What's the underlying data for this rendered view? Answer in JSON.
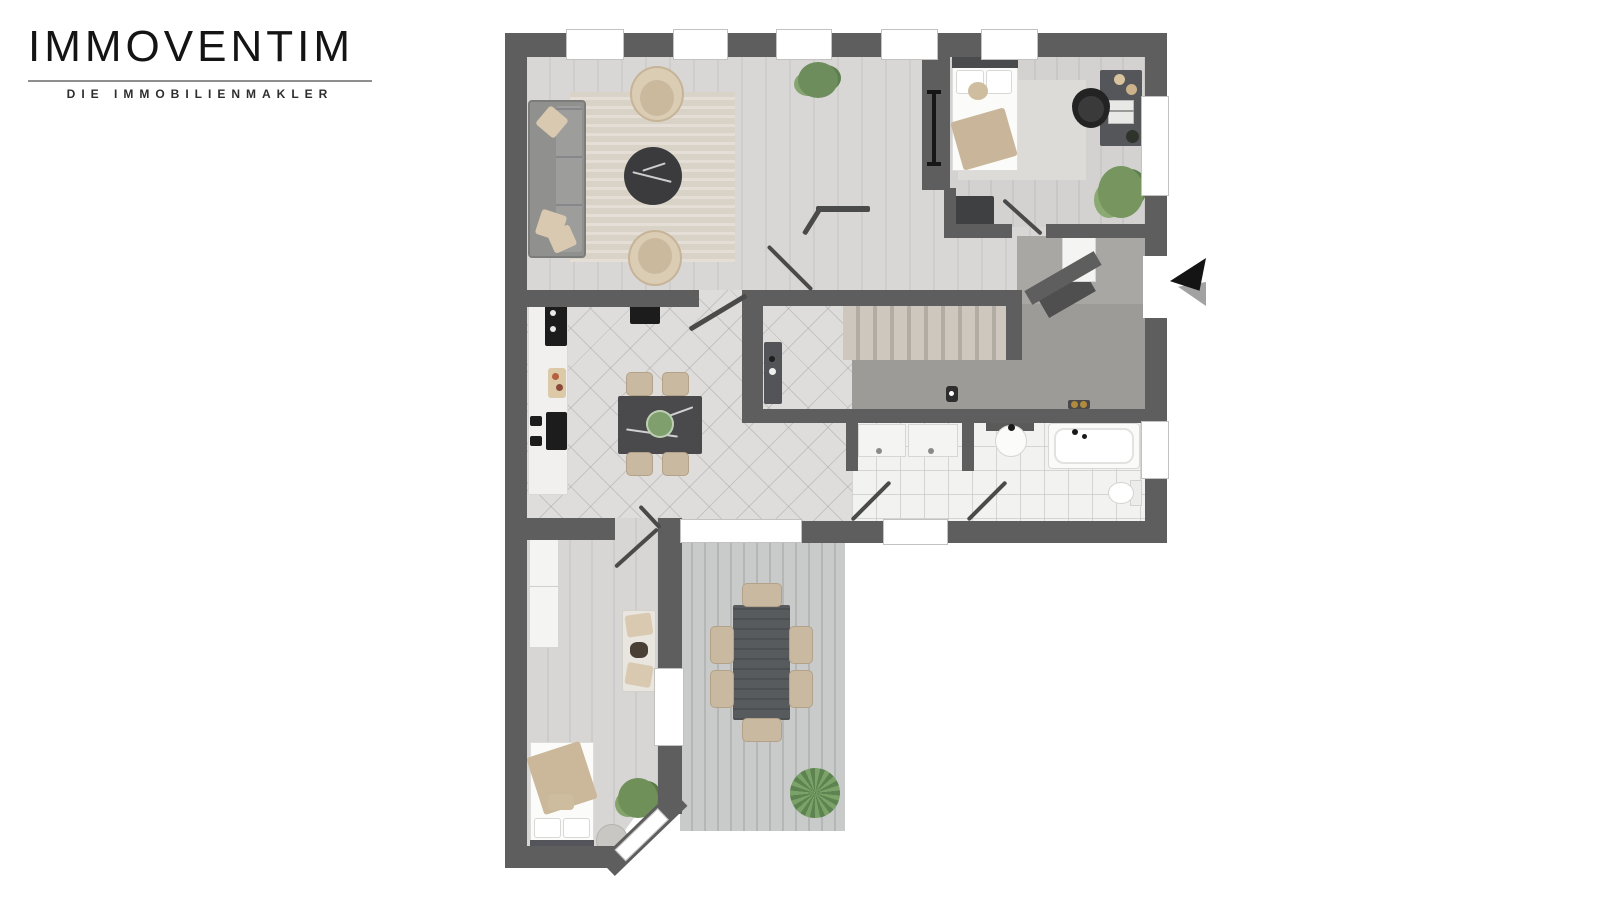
{
  "brand": {
    "name": "IMMOVENTIM",
    "tagline": "DIE IMMOBILIENMAKLER"
  },
  "floorplan": {
    "style": "3d-rendered-top-view",
    "entrance": {
      "side": "right",
      "marker": "black-arrow-pointing-left"
    },
    "palette": {
      "wall": "#5e5e5e",
      "wood_floor": "#d6d5d3",
      "hall_carpet": "#9c9b97",
      "bath_tile": "#f2f2f0",
      "deck": "#c0c3c2",
      "stairs": "#c6bfb5",
      "upholstery_beige": "#d3c3aa",
      "sofa_gray": "#90908e",
      "plant_green": "#76955f",
      "accent_gold": "#b08a3e"
    },
    "windows": {
      "top_wall": 5,
      "right_wall": 2,
      "bottom_wall": 2,
      "lower_bedroom": 2
    },
    "rooms": [
      {
        "id": "living-room",
        "furniture": [
          "sofa",
          "armchair",
          "armchair",
          "round-coffee-table",
          "rug",
          "plant"
        ]
      },
      {
        "id": "kitchen-dining",
        "furniture": [
          "kitchen-counter",
          "cooktop",
          "sink",
          "cutting-board",
          "dining-table",
          "chair",
          "chair",
          "chair",
          "chair",
          "fireplace"
        ]
      },
      {
        "id": "bedroom-upper",
        "furniture": [
          "double-bed",
          "closet-rail",
          "dresser",
          "desk",
          "laptop",
          "office-chair",
          "plant",
          "rug"
        ]
      },
      {
        "id": "stair-hall",
        "furniture": [
          "staircase",
          "wall-cabinet",
          "decor-object",
          "gold-decor"
        ]
      },
      {
        "id": "entry",
        "furniture": [
          "corner-cabinet"
        ]
      },
      {
        "id": "laundry",
        "furniture": [
          "washing-machine",
          "dryer"
        ]
      },
      {
        "id": "bathroom",
        "furniture": [
          "washbasin",
          "bathtub",
          "toilet"
        ]
      },
      {
        "id": "bedroom-lower",
        "furniture": [
          "bed",
          "wardrobe",
          "daybed",
          "pouf",
          "plant"
        ]
      },
      {
        "id": "terrace",
        "furniture": [
          "outdoor-table",
          "chair",
          "chair",
          "chair",
          "chair",
          "chair",
          "chair",
          "plant"
        ]
      }
    ]
  }
}
